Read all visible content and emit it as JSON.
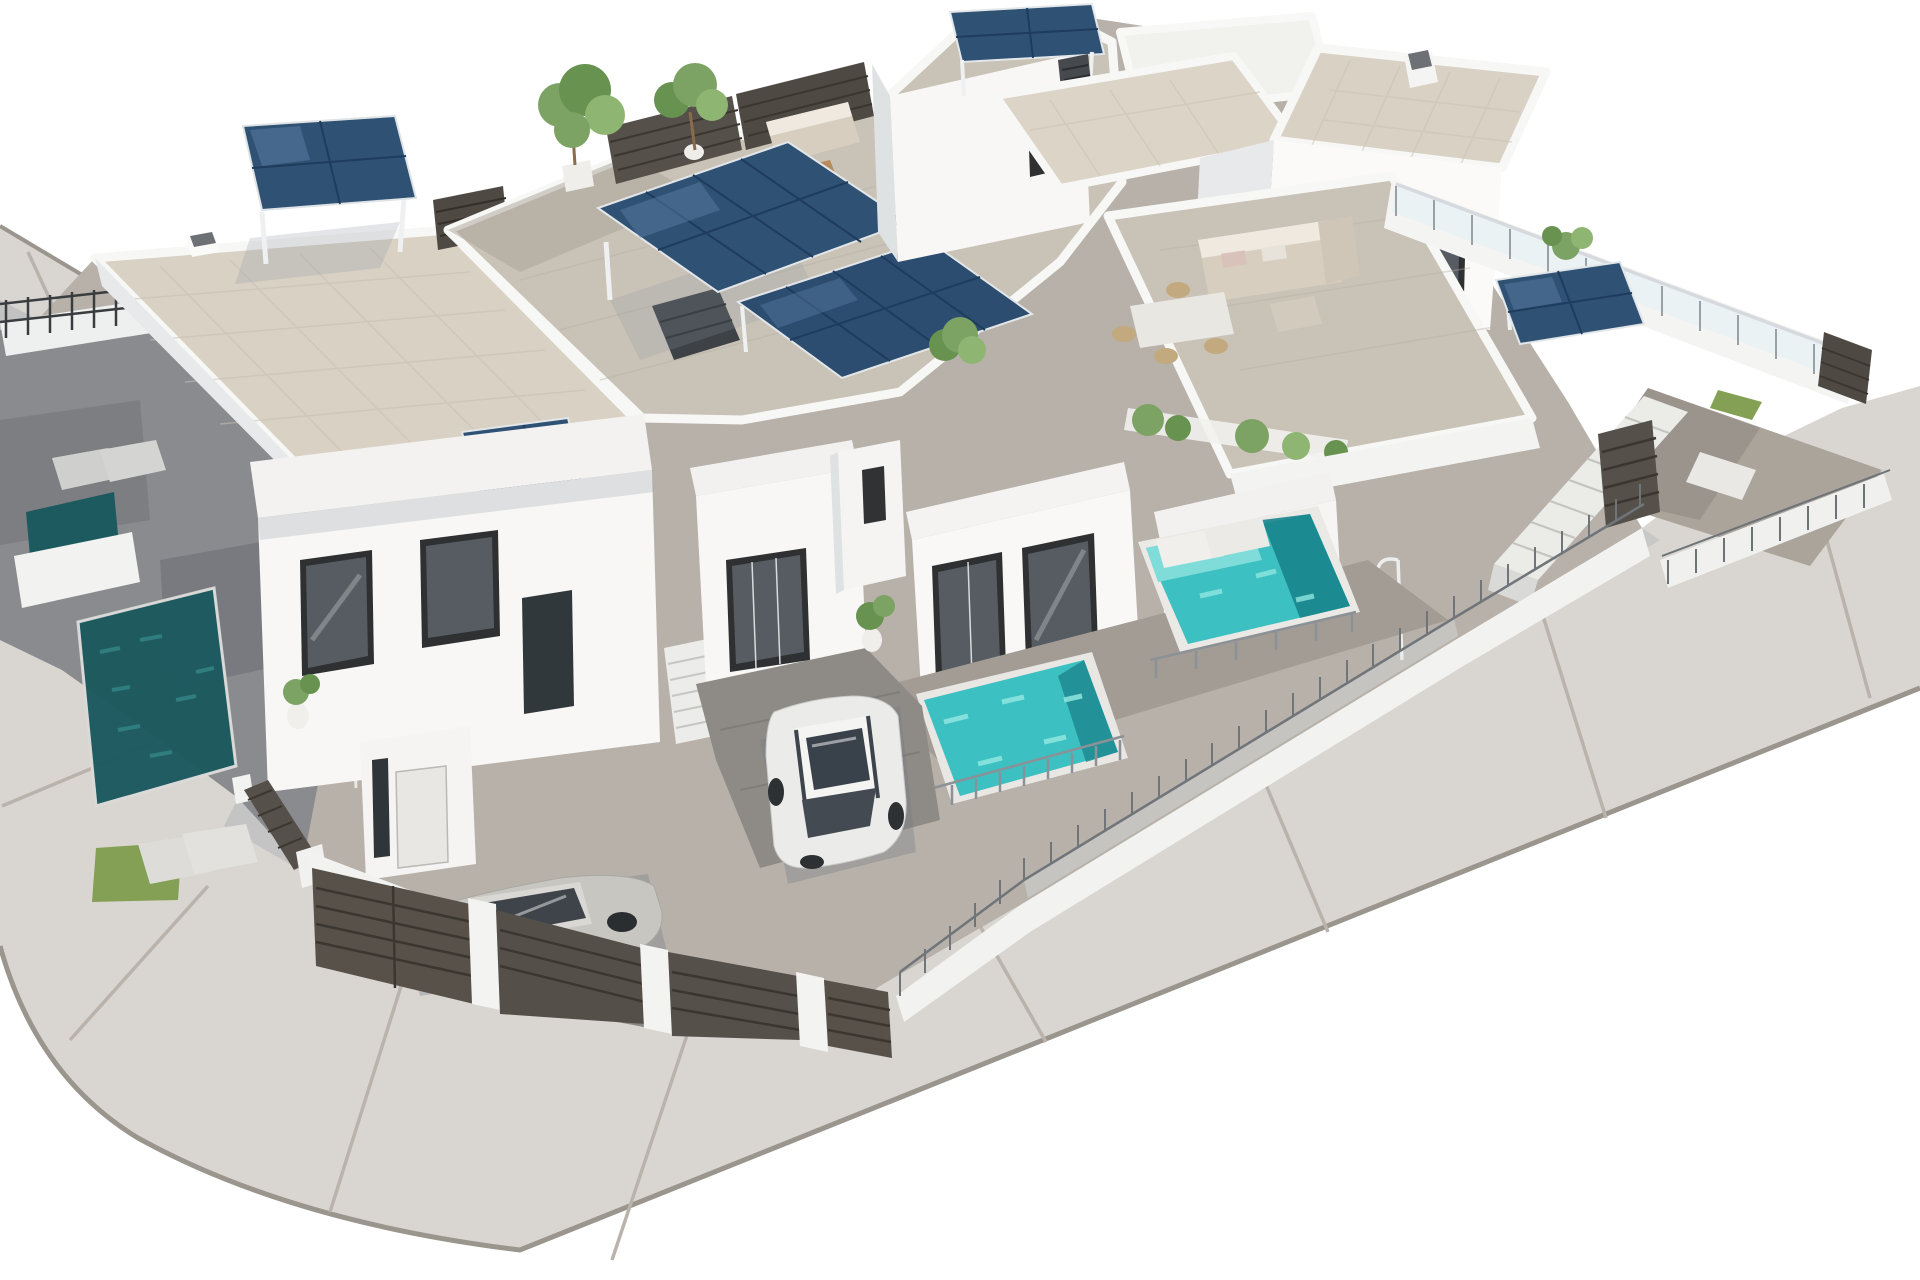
{
  "meta": {
    "type": "architectural-3d-render",
    "description": "Aerial 3D render of a modern white villa development: flat-roofed terraced houses with beige tiled roofs, rooftop terraces with outdoor furniture, dark blue solar panel pergolas, turquoise and deep-teal plunge pools, dark wood slatted gates and fences, glass railings, two parked cars (one white, one silver), potted plants and small trees, all wrapped by a curving light-gray road with expansion joints and a rounded corner on white ground."
  },
  "palette": {
    "background": "#ffffff",
    "road": "#d9d6d1",
    "road_joint": "#b9b3ab",
    "curb": "#9a958d",
    "base": "#b7b1a9",
    "terrace_sun": "#c9c2b7",
    "terrace_shade": "#898b8e",
    "wall_light": "#f8f7f5",
    "wall_mid": "#eef0ef",
    "wall_shade": "#e7e9ea",
    "wall_dark": "#dfe2e3",
    "roof_tile": "#d8d1c4",
    "roof_tile_light": "#dbd4c7",
    "pool_dark": "#1d5a5f",
    "pool_bright": "#3cc0c2",
    "pool_shelf": "#7fdcd8",
    "pool_deep": "#17858c",
    "solar": "#2f5174",
    "solar_grid": "#1d3c5e",
    "solar_glare": "#5d80a6",
    "wood_dark": "#55504a",
    "wood_slat": "#3b362f",
    "frame_dark": "#2e3032",
    "glass_dark": "#565c62",
    "green": "#7da364",
    "green_dark": "#68924f",
    "green_light": "#8fb573",
    "lawn": "#84a054",
    "car_white": "#ebebe9",
    "car_silver": "#c7c6c0",
    "car_glass": "#3e4449",
    "sofa": "#d7cec0",
    "wicker": "#c2a97e",
    "cushion": "#e0a84e",
    "wood_table": "#b98a5a",
    "metal": "#70757a",
    "shadow": "#8e96a2"
  },
  "objects": [
    "curving-road",
    "expansion-joints",
    "rounded-curb-corner",
    "tiled-roof-villa-back-left",
    "solar-pergola-back-left",
    "rooftop-terrace-center",
    "outdoor-kitchen",
    "solar-array-large",
    "solar-array-lower",
    "solar-roof-tower",
    "tiled-roof-villas-top-right",
    "chimney",
    "rooftop-lounge-right",
    "l-shaped-sofa",
    "dining-table",
    "planter-shrubs",
    "glass-balustrade-right",
    "solar-pergola-right",
    "exterior-stairs",
    "wood-gate-right",
    "shaded-terrace-left",
    "plunge-pool-dark-left",
    "sun-loungers",
    "lawn-patch",
    "outdoor-shower",
    "front-villa-left",
    "front-villa-center",
    "front-villa-right",
    "sliding-glass-doors",
    "front-door",
    "entry-stairs",
    "bright-pool-center",
    "bright-pool-right-with-loungers",
    "pool-railings",
    "white-car",
    "silver-car",
    "driveway",
    "slatted-gates-front",
    "white-fence-wall",
    "metal-railing-fence",
    "trees",
    "potted-plants",
    "wicker-armchairs",
    "round-dining-set",
    "solar-pergola-table"
  ]
}
